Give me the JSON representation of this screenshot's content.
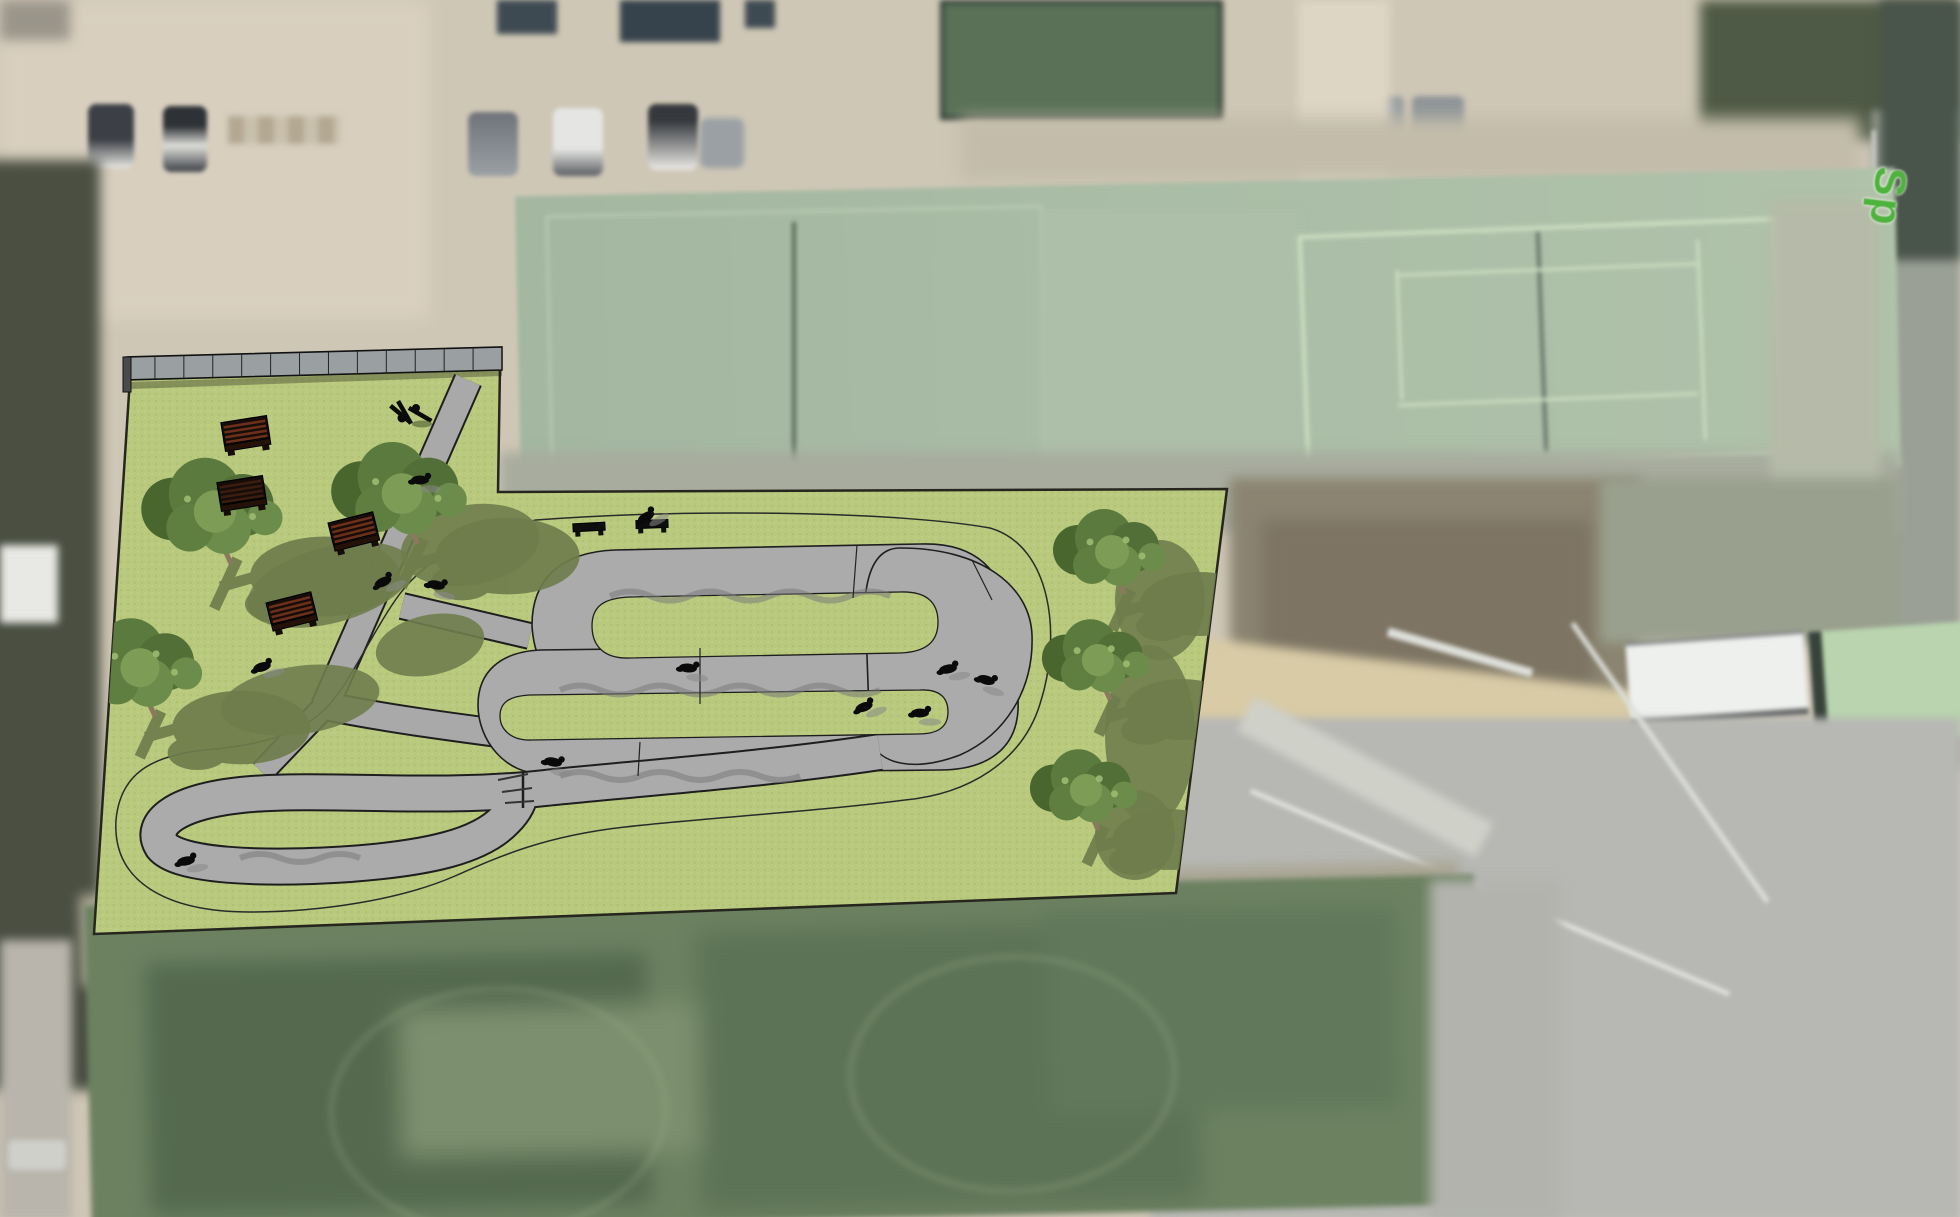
{
  "meta": {
    "view": "aerial-satellite-photo-with-site-plan-overlay",
    "description": "Satellite photo of a sports complex (parking lot, tennis courts, soccer field) with a 3D-rendered pump-track park concept overlaid on a light-green parcel"
  },
  "map": {
    "street_label": {
      "text": "Sp",
      "color": "#4db33c"
    }
  },
  "palette": {
    "satellite_tan": "#cfc7b6",
    "court_green": "#a7bba5",
    "field_green": "#6b8160",
    "parcel_green": "#b9c97d",
    "track_gray": "#ababab",
    "outline_dark": "#1e1e1e",
    "shadow_olive": "#6f7d4c",
    "bench_brown": "#5f2c18"
  },
  "overlay": {
    "parcel_outline": "M130,378 L500,367 L498,492 L1227,489 L1176,893 L94,934 Z",
    "trees": [
      {
        "x": 215,
        "y": 514,
        "s": 1.25
      },
      {
        "x": 402,
        "y": 496,
        "s": 1.2
      },
      {
        "x": 140,
        "y": 670,
        "s": 1.15
      },
      {
        "x": 1112,
        "y": 554,
        "s": 1.0
      },
      {
        "x": 1098,
        "y": 662,
        "s": 0.95
      },
      {
        "x": 1086,
        "y": 792,
        "s": 0.95
      }
    ],
    "shadow_blobs": [
      {
        "x": 330,
        "y": 585,
        "rx": 85,
        "ry": 38,
        "rot": -15
      },
      {
        "x": 470,
        "y": 545,
        "rx": 70,
        "ry": 40,
        "rot": -10
      },
      {
        "x": 300,
        "y": 700,
        "rx": 80,
        "ry": 34,
        "rot": -8
      },
      {
        "x": 430,
        "y": 645,
        "rx": 55,
        "ry": 30,
        "rot": -12
      },
      {
        "x": 1160,
        "y": 600,
        "rx": 45,
        "ry": 60,
        "rot": 0
      },
      {
        "x": 1150,
        "y": 735,
        "rx": 45,
        "ry": 90,
        "rot": 0
      },
      {
        "x": 1135,
        "y": 835,
        "rx": 40,
        "ry": 45,
        "rot": 0
      }
    ],
    "benches": [
      {
        "x": 354,
        "y": 532,
        "rot": -14,
        "type": "back"
      },
      {
        "x": 292,
        "y": 612,
        "rot": -14,
        "type": "back"
      },
      {
        "x": 246,
        "y": 434,
        "rot": -9,
        "type": "back"
      },
      {
        "x": 242,
        "y": 494,
        "rot": -9,
        "type": "dark"
      },
      {
        "x": 589,
        "y": 527,
        "rot": -3,
        "type": "flat"
      },
      {
        "x": 652,
        "y": 524,
        "rot": -2,
        "type": "flat"
      }
    ],
    "riders": [
      {
        "x": 383,
        "y": 582,
        "rot": -25
      },
      {
        "x": 436,
        "y": 585,
        "rot": 10
      },
      {
        "x": 262,
        "y": 667,
        "rot": -15
      },
      {
        "x": 646,
        "y": 517,
        "rot": -30
      },
      {
        "x": 688,
        "y": 668,
        "rot": 5
      },
      {
        "x": 948,
        "y": 669,
        "rot": -10
      },
      {
        "x": 986,
        "y": 680,
        "rot": 15
      },
      {
        "x": 920,
        "y": 713,
        "rot": 0
      },
      {
        "x": 864,
        "y": 707,
        "rot": -20
      },
      {
        "x": 553,
        "y": 762,
        "rot": 10
      },
      {
        "x": 186,
        "y": 861,
        "rot": -10
      },
      {
        "x": 420,
        "y": 480,
        "rot": 0
      }
    ],
    "bike_rack": {
      "x": 408,
      "y": 414
    },
    "wall": {
      "x1": 126,
      "y1": 357,
      "x2": 502,
      "y2": 347,
      "height": 23,
      "panels": 13
    }
  },
  "satellite_features": {
    "parking_cars_visible": 10,
    "tennis_courts": 2,
    "soccer_field": 1,
    "buildings": [
      "dark-roof-sheds",
      "green-roof-structure",
      "white-roof-building",
      "small-white-shed",
      "small-green-court"
    ]
  }
}
